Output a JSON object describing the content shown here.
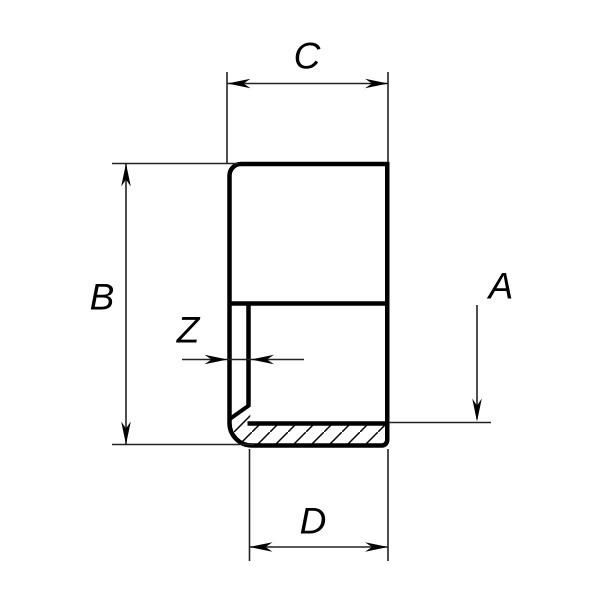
{
  "drawing": {
    "labels": {
      "top_width": "C",
      "left_height": "B",
      "wall_thickness": "Z",
      "right_depth": "A",
      "bottom_width": "D"
    }
  },
  "colors": {
    "part_outline": "#000000",
    "dimension_lines": "#222222",
    "background": "#ffffff"
  }
}
